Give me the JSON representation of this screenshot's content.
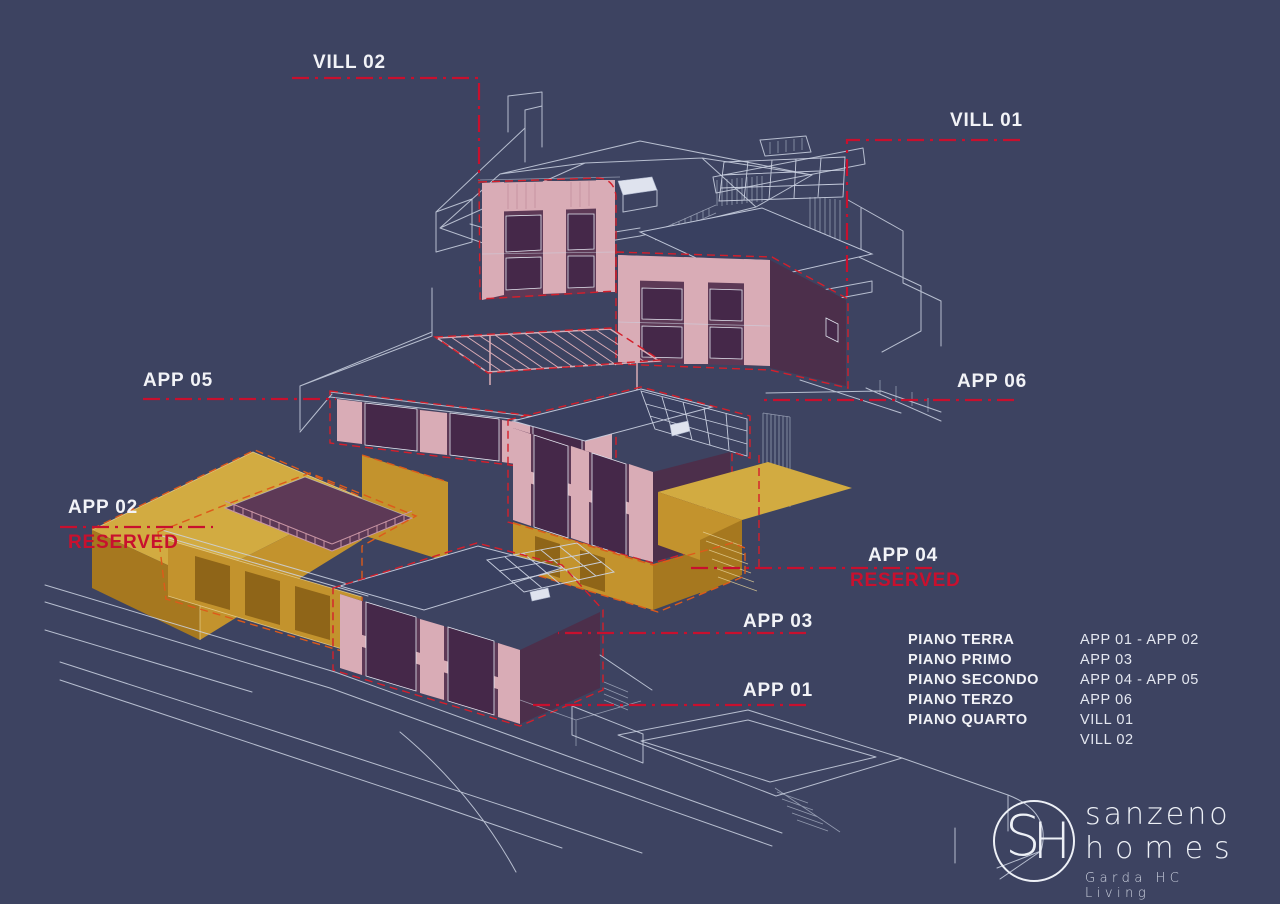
{
  "scene": {
    "description": "Axonometric site plan of hillside residential development with highlighted units",
    "background": "#3d4361"
  },
  "labels": {
    "vill02": "VILL 02",
    "vill01": "VILL 01",
    "app05": "APP 05",
    "app06": "APP 06",
    "app04": "APP 04",
    "app03": "APP 03",
    "app02": "APP 02",
    "app01": "APP 01",
    "reserved": "RESERVED"
  },
  "legend": {
    "rows": [
      {
        "floor": "PIANO TERRA",
        "units": "APP 01 - APP 02"
      },
      {
        "floor": "PIANO PRIMO",
        "units": "APP 03"
      },
      {
        "floor": "PIANO SECONDO",
        "units": "APP 04 - APP 05"
      },
      {
        "floor": "PIANO TERZO",
        "units": "APP 06"
      },
      {
        "floor": "PIANO QUARTO",
        "units": "VILL 01"
      },
      {
        "floor": "",
        "units": "VILL 02"
      }
    ]
  },
  "logo": {
    "monogram_s": "S",
    "monogram_h": "H",
    "line1": "sanzeno",
    "line2": "homes",
    "tagline": "Garda HC Living"
  },
  "colors": {
    "background": "#3d4361",
    "wireframe": "#ccd3e3",
    "highlight_pink": "#d9acb6",
    "highlight_plum": "#5d3956",
    "highlight_gold": "#c3932d",
    "accent_red": "#c8102e",
    "accent_orange": "#dd5a1a",
    "text_white": "#f2f3f7"
  }
}
